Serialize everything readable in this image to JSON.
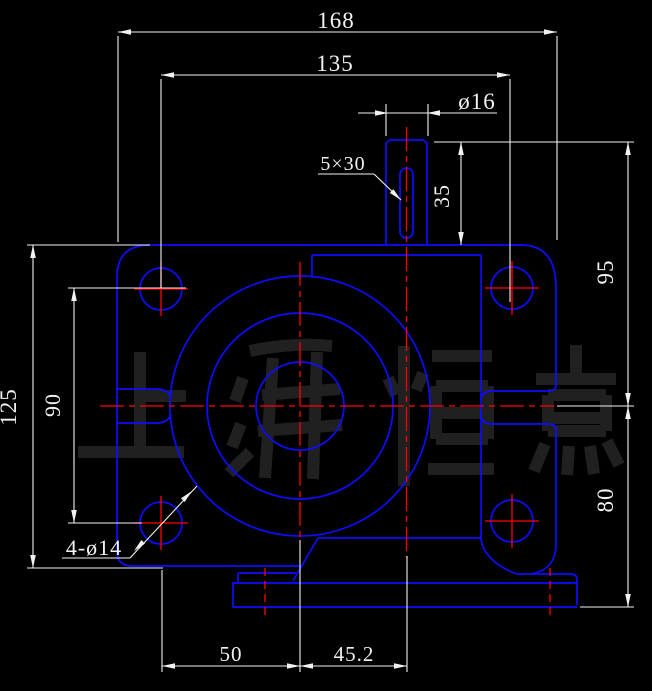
{
  "colors": {
    "background": "#000000",
    "line": "#0d0dff",
    "centerline": "#ff0000",
    "dimension": "#f2f2f2",
    "watermark": "#202020"
  },
  "watermark": {
    "text": "上海恒点"
  },
  "dim_labels": [
    {
      "id": "label-168",
      "text": "168",
      "x": 336,
      "y": 28,
      "r": 0,
      "s": 23
    },
    {
      "id": "label-135",
      "text": "135",
      "x": 335,
      "y": 71,
      "r": 0,
      "s": 23
    },
    {
      "id": "label-dia16",
      "text": "ø16",
      "x": 477,
      "y": 109,
      "r": 0,
      "s": 23
    },
    {
      "id": "label-5x30",
      "text": "5×30",
      "x": 343,
      "y": 170,
      "r": 0,
      "s": 20
    },
    {
      "id": "label-35",
      "text": "35",
      "x": 449,
      "y": 196,
      "r": -90,
      "s": 22
    },
    {
      "id": "label-95",
      "text": "95",
      "x": 613,
      "y": 272,
      "r": -90,
      "s": 23
    },
    {
      "id": "label-80",
      "text": "80",
      "x": 613,
      "y": 500,
      "r": -90,
      "s": 23
    },
    {
      "id": "label-125",
      "text": "125",
      "x": 16,
      "y": 407,
      "r": -90,
      "s": 23
    },
    {
      "id": "label-90",
      "text": "90",
      "x": 60,
      "y": 405,
      "r": -90,
      "s": 22
    },
    {
      "id": "label-4dia14",
      "text": "4-ø14",
      "x": 94,
      "y": 555,
      "r": 0,
      "s": 22
    },
    {
      "id": "label-50",
      "text": "50",
      "x": 231,
      "y": 661,
      "r": 0,
      "s": 21
    },
    {
      "id": "label-45_2",
      "text": "45.2",
      "x": 354,
      "y": 661,
      "r": 0,
      "s": 21
    }
  ]
}
